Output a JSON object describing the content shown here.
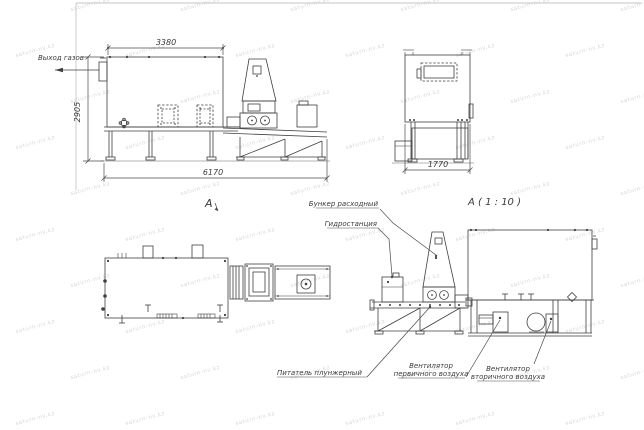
{
  "watermark": {
    "text": "saturn-nv.kz",
    "color": "#d7d7db"
  },
  "labels": {
    "gas_outlet": "Выход газов",
    "view_arrow": "А",
    "detail_title": "А ( 1 : 10 )",
    "hopper": "Бункер расходный",
    "hydrostation": "Гидростанция",
    "plunger_feeder": "Питатель плунжерный",
    "primary_fan_line1": "Вентилятор",
    "primary_fan_line2": "первичного воздуха",
    "secondary_fan_line1": "Вентилятор",
    "secondary_fan_line2": "вторичного воздуха"
  },
  "dimensions": {
    "overall_width_top": "3380",
    "overall_height": "2905",
    "overall_length": "6170",
    "end_width": "1770"
  }
}
